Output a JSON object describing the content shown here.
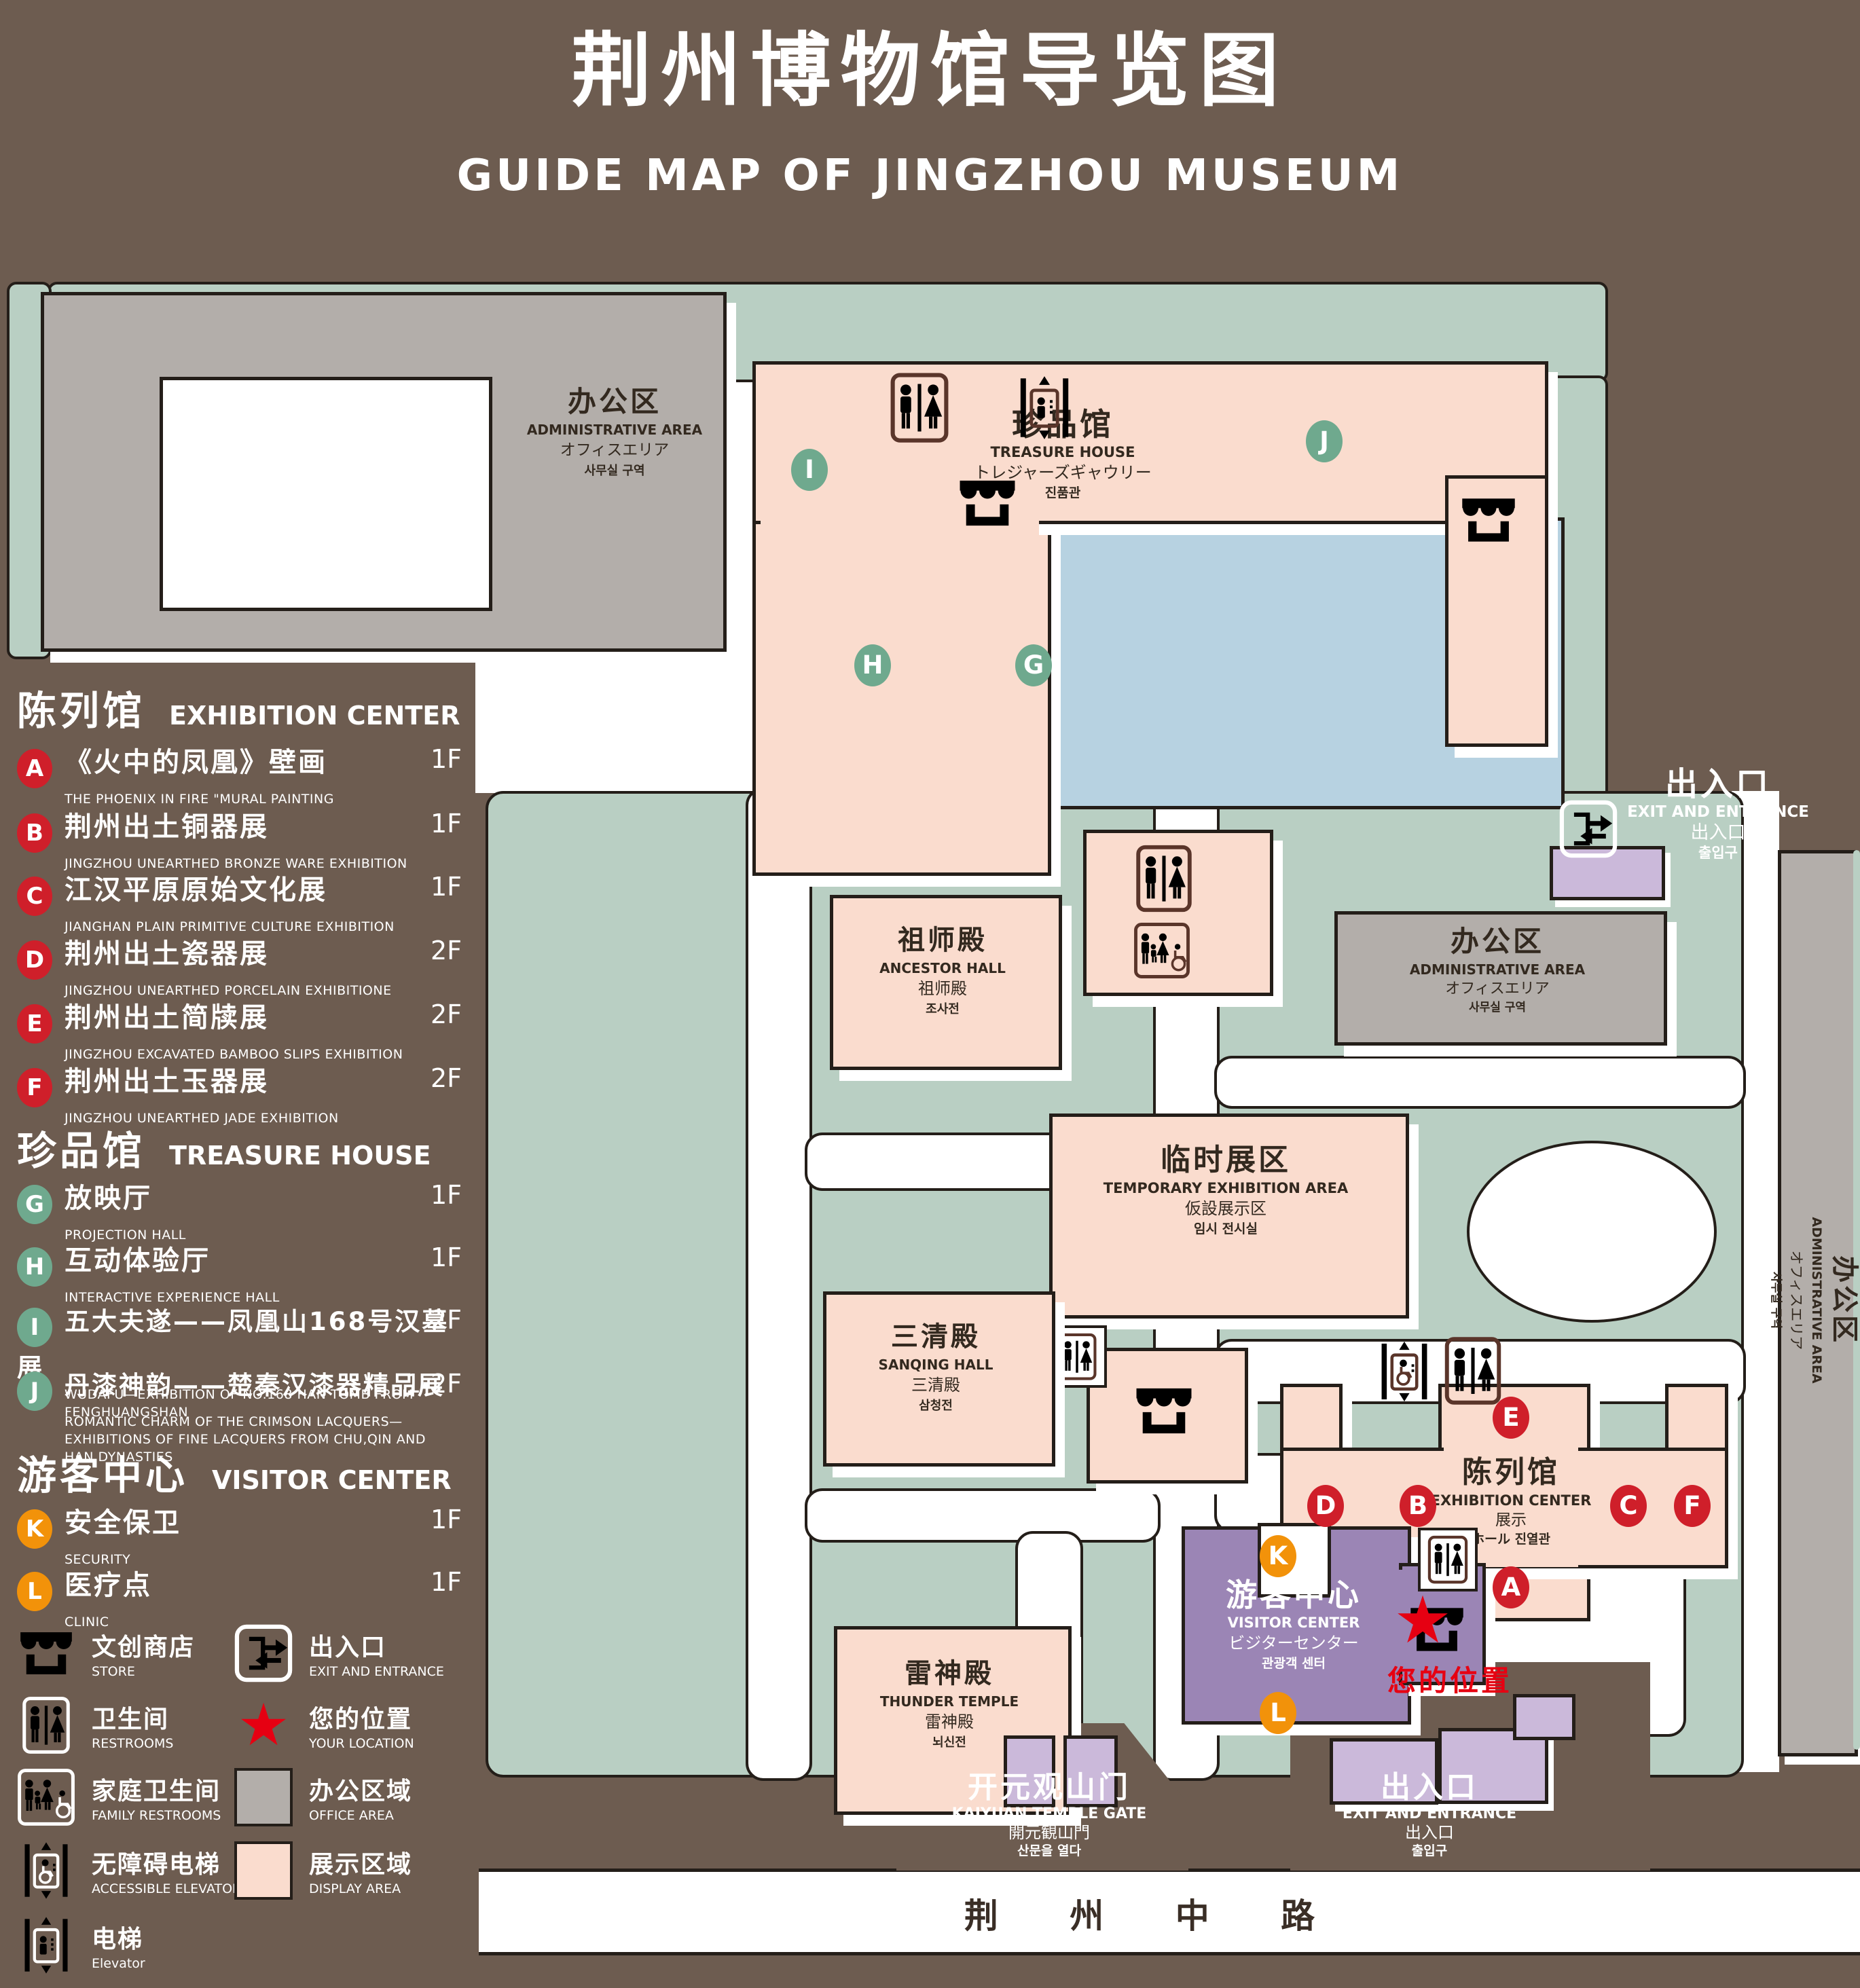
{
  "header": {
    "title": "荆州博物馆导览图",
    "subtitle": "GUIDE MAP OF JINGZHOU MUSEUM"
  },
  "legend": {
    "sections": [
      {
        "zh": "陈列馆",
        "en": "EXHIBITION CENTER"
      },
      {
        "zh": "珍品馆",
        "en": "TREASURE HOUSE"
      },
      {
        "zh": "游客中心",
        "en": "VISITOR CENTER"
      }
    ],
    "items": [
      {
        "id": "A",
        "zh": "《火中的凤凰》壁画",
        "en": "THE PHOENIX IN FIRE \"MURAL PAINTING",
        "floor": "1F"
      },
      {
        "id": "B",
        "zh": "荆州出土铜器展",
        "en": "JINGZHOU UNEARTHED BRONZE WARE EXHIBITION",
        "floor": "1F"
      },
      {
        "id": "C",
        "zh": "江汉平原原始文化展",
        "en": "JIANGHAN PLAIN PRIMITIVE CULTURE EXHIBITION",
        "floor": "1F"
      },
      {
        "id": "D",
        "zh": "荆州出土瓷器展",
        "en": "JINGZHOU UNEARTHED PORCELAIN EXHIBITIONE",
        "floor": "2F"
      },
      {
        "id": "E",
        "zh": "荆州出土简牍展",
        "en": "JINGZHOU EXCAVATED BAMBOO SLIPS EXHIBITION",
        "floor": "2F"
      },
      {
        "id": "F",
        "zh": "荆州出土玉器展",
        "en": "JINGZHOU UNEARTHED JADE EXHIBITION",
        "floor": "2F"
      },
      {
        "id": "G",
        "zh": "放映厅",
        "en": "PROJECTION HALL",
        "floor": "1F"
      },
      {
        "id": "H",
        "zh": "互动体验厅",
        "en": "INTERACTIVE EXPERIENCE HALL",
        "floor": "1F"
      },
      {
        "id": "I",
        "zh": "五大夫遂——凤凰山168号汉墓展",
        "en": "WUDAFU—EXHIBITION OF NO.168 HAN TOMB FROM FENGHUANGSHAN",
        "floor": "2F"
      },
      {
        "id": "J",
        "zh": "丹漆神韵——楚秦汉漆器精品展",
        "en": "ROMANTIC CHARM OF THE CRIMSON LACQUERS—EXHIBITIONS OF FINE LACQUERS FROM CHU,QIN AND HAN DYNASTIES",
        "floor": "1-2F"
      },
      {
        "id": "K",
        "zh": "安全保卫",
        "en": "SECURITY",
        "floor": "1F"
      },
      {
        "id": "L",
        "zh": "医疗点",
        "en": "CLINIC",
        "floor": "1F"
      }
    ],
    "symbols": [
      {
        "zh": "文创商店",
        "en": "STORE"
      },
      {
        "zh": "卫生间",
        "en": "RESTROOMS"
      },
      {
        "zh": "家庭卫生间",
        "en": "FAMILY RESTROOMS"
      },
      {
        "zh": "无障碍电梯",
        "en": "ACCESSIBLE ELEVATOR"
      },
      {
        "zh": "电梯",
        "en": "Elevator"
      },
      {
        "zh": "出入口",
        "en": "EXIT AND ENTRANCE"
      },
      {
        "zh": "您的位置",
        "en": "YOUR LOCATION"
      },
      {
        "zh": "办公区域",
        "en": "OFFICE AREA"
      },
      {
        "zh": "展示区域",
        "en": "DISPLAY AREA"
      }
    ]
  },
  "map": {
    "admin": {
      "zh": "办公区",
      "en": "ADMINISTRATIVE AREA",
      "ja": "オフィスエリア",
      "ko": "사무실 구역"
    },
    "treasure": {
      "zh": "珍品馆",
      "en": "TREASURE HOUSE",
      "ja": "トレジャーズギャウリー",
      "ko": "진품관"
    },
    "ancestor": {
      "zh": "祖师殿",
      "en": "ANCESTOR HALL",
      "ja": "祖师殿",
      "ko": "조사전"
    },
    "sanqing": {
      "zh": "三清殿",
      "en": "SANQING HALL",
      "ja": "三清殿",
      "ko": "삼청전"
    },
    "thunder": {
      "zh": "雷神殿",
      "en": "THUNDER TEMPLE",
      "ja": "雷神殿",
      "ko": "뇌신전"
    },
    "temporary": {
      "zh": "临时展区",
      "en": "TEMPORARY EXHIBITION AREA",
      "ja": "仮設展示区",
      "ko": "임시 전시실"
    },
    "visitor": {
      "zh": "游客中心",
      "en": "VISITOR CENTER",
      "ja": "ビジターセンター",
      "ko": "관광객 센터"
    },
    "exhibition": {
      "zh": "陈列馆",
      "en": "EXHIBITION CENTER",
      "ja": "展示",
      "ko": "ホール 진열관"
    },
    "exit": {
      "zh": "出入口",
      "en": "EXIT AND ENTRANCE",
      "ja": "出入口",
      "ko": "출입구"
    },
    "gate": {
      "zh": "开元观山门",
      "en": "KAIYUAN TEMPLE GATE",
      "ja": "開元観山門",
      "ko": "산문을 열다"
    },
    "road": "荆 州 中 路",
    "your_location": "您的位置",
    "markers": {
      "A": "A",
      "B": "B",
      "C": "C",
      "D": "D",
      "E": "E",
      "F": "F",
      "G": "G",
      "H": "H",
      "I": "I",
      "J": "J",
      "K": "K",
      "L": "L"
    }
  }
}
